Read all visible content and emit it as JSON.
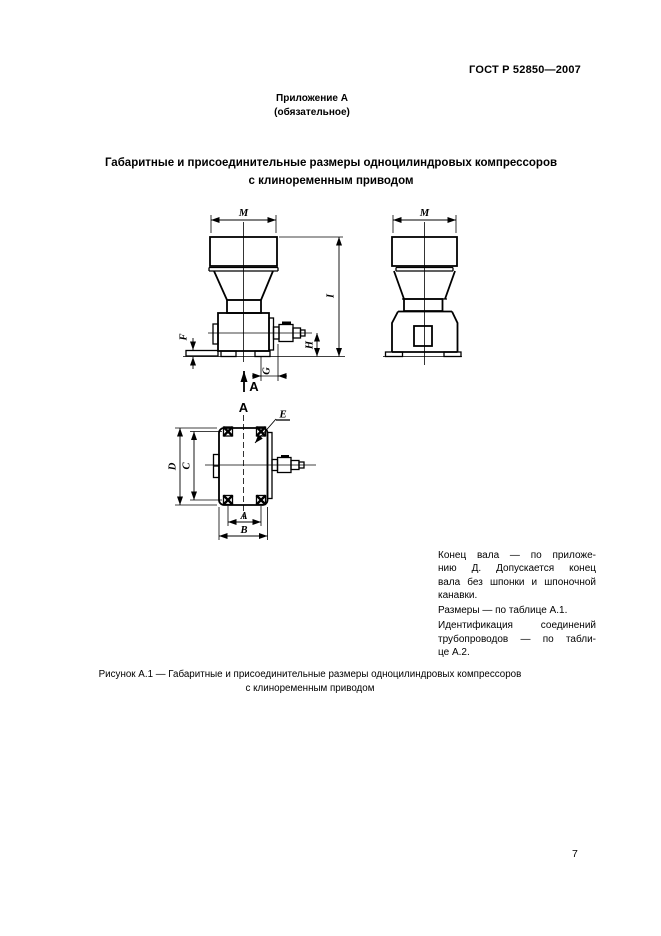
{
  "page": {
    "standard_code": "ГОСТ Р 52850—2007",
    "appendix_title": "Приложение А",
    "appendix_subtitle": "(обязательное)",
    "title_line1": "Габаритные и присоединительные размеры одноцилиндровых компрессоров",
    "title_line2": "с клиноременным приводом",
    "page_number": "7"
  },
  "figure": {
    "dim_labels": {
      "m_front": "M",
      "m_side": "M",
      "i": "I",
      "h": "H",
      "f": "F",
      "g": "G",
      "view_arrow": "А",
      "view_title": "А",
      "e": "E",
      "d": "D",
      "c": "C",
      "a": "A",
      "b": "B"
    },
    "caption_line1": "Рисунок А.1 — Габаритные и присоединительные размеры одноцилиндровых компрессоров",
    "caption_line2": "с клиноременным приводом"
  },
  "notes": {
    "lines": [
      "Конец вала — по приложе-",
      "нию Д. Допускается конец",
      "вала без шпонки и шпоночной",
      "канавки.",
      "Размеры — по таблице А.1.",
      "Идентификация соединений",
      "трубопроводов — по табли-",
      "це А.2."
    ]
  }
}
